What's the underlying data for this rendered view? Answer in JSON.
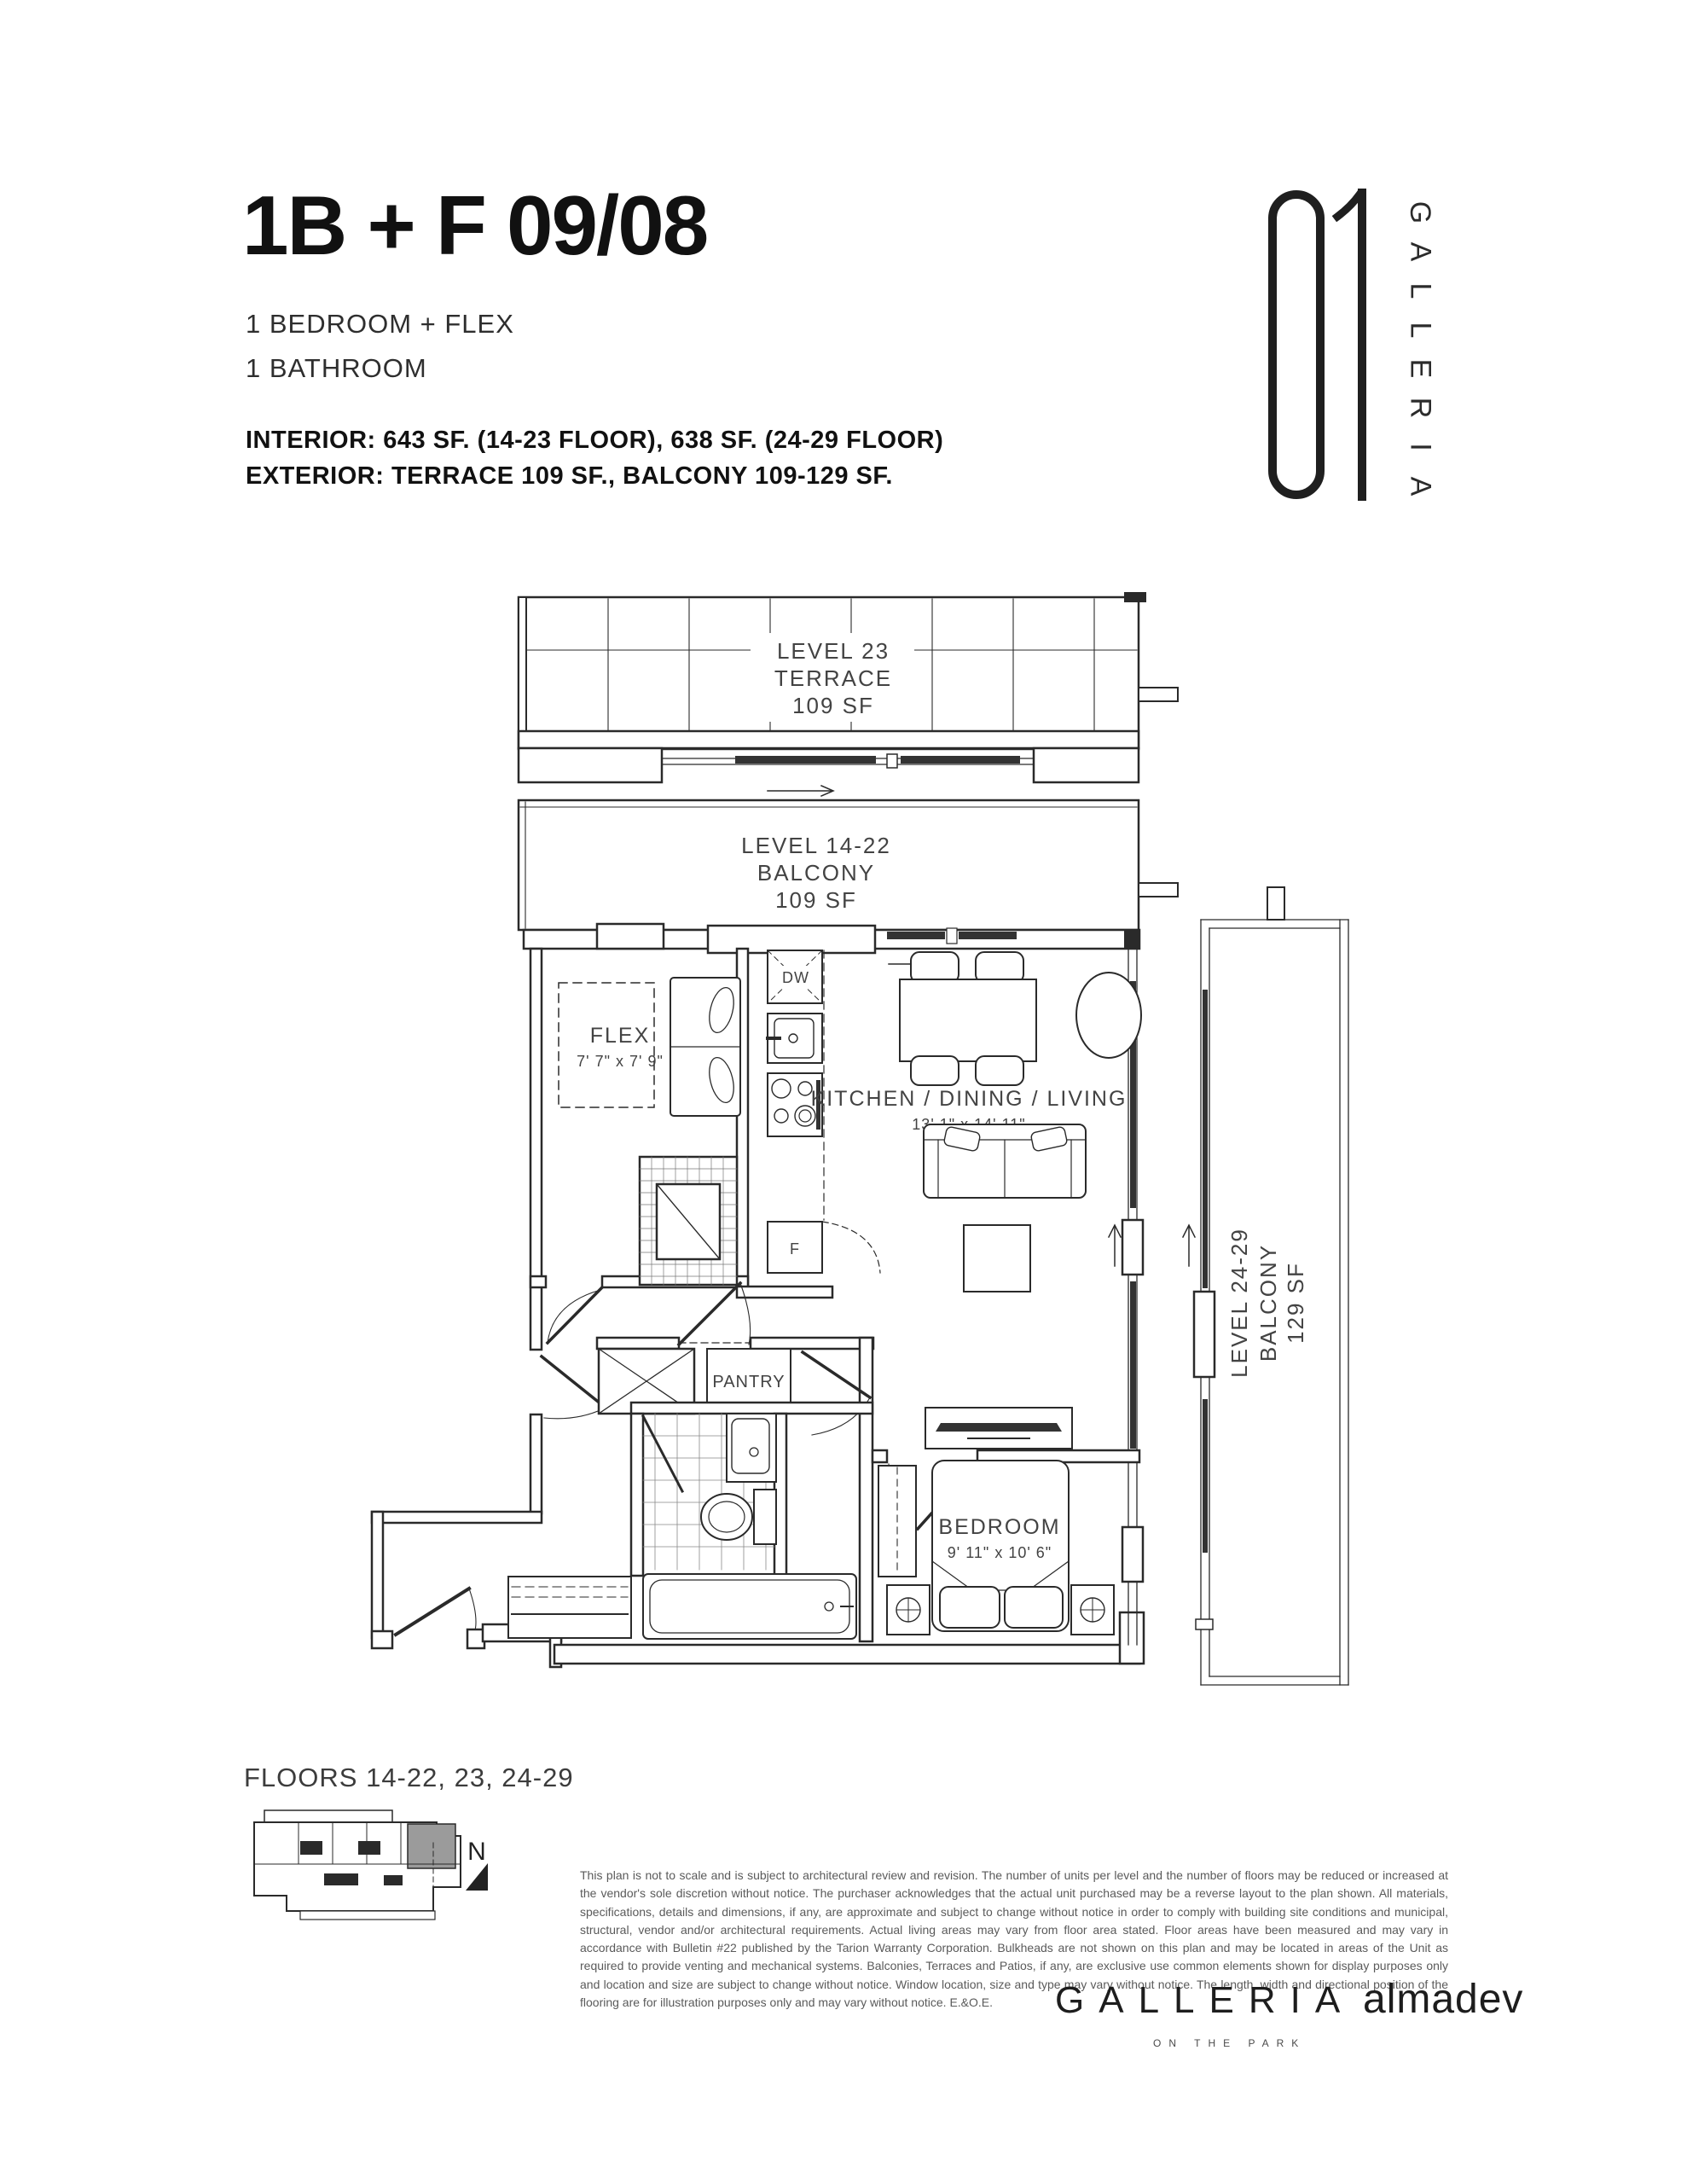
{
  "header": {
    "plan_code": "1B + F 09/08",
    "config_lines": [
      "1 BEDROOM + FLEX",
      "1 BATHROOM"
    ],
    "interior_spec": "INTERIOR: 643 SF. (14-23 FLOOR), 638 SF. (24-29 FLOOR)",
    "exterior_spec": "EXTERIOR: TERRACE 109 SF., BALCONY 109-129 SF."
  },
  "logo": {
    "number": "01",
    "letters": [
      "G",
      "A",
      "L",
      "L",
      "E",
      "R",
      "I",
      "A"
    ]
  },
  "plan": {
    "terrace_label": {
      "line1": "LEVEL 23",
      "line2": "TERRACE",
      "line3": "109 SF"
    },
    "balcony_label": {
      "line1": "LEVEL 14-22",
      "line2": "BALCONY",
      "line3": "109 SF"
    },
    "side_balcony_label": {
      "line1": "LEVEL 24-29",
      "line2": "BALCONY",
      "line3": "129 SF"
    },
    "rooms": {
      "flex": {
        "name": "FLEX",
        "dims": "7' 7\" x 7' 9\""
      },
      "kitchen_dining_living": {
        "name": "KITCHEN / DINING / LIVING",
        "dims": "13' 1\" x 14' 11\""
      },
      "bedroom": {
        "name": "BEDROOM",
        "dims": "9' 11\" x 10' 6\""
      },
      "pantry": {
        "name": "PANTRY"
      }
    },
    "appliances": {
      "dishwasher": "DW",
      "fridge": "F"
    }
  },
  "footer": {
    "floors_label": "FLOORS 14-22, 23, 24-29",
    "north_label": "N",
    "disclaimer": "This plan is not to scale and is subject to architectural review and revision. The number of units per level and the number of floors may be reduced or increased at the vendor's sole discretion without notice. The purchaser acknowledges that the actual unit purchased may be a reverse layout to the plan shown. All materials, specifications, details and dimensions, if any, are approximate and subject to change without notice in order to comply with building site conditions and municipal, structural, vendor and/or architectural requirements. Actual living areas may vary from floor area stated. Floor areas have been measured and may vary in accordance with Bulletin #22 published by the Tarion Warranty Corporation. Bulkheads are not shown on this plan and may be located in areas of the Unit as required to provide venting and mechanical systems. Balconies, Terraces and Patios, if any, are exclusive use common elements shown for display purposes only and location and size are subject to change without notice. Window location, size and type may vary without notice. The length, width and directional position of the flooring are for illustration purposes only and may vary without notice. E.&O.E.",
    "brand": {
      "name": "GALLERIA",
      "tagline": "ON THE PARK",
      "developer": "almadev"
    }
  },
  "colors": {
    "ink": "#2a2a2a",
    "label_gray": "#434343",
    "unit_highlight": "#9b9b9b"
  }
}
